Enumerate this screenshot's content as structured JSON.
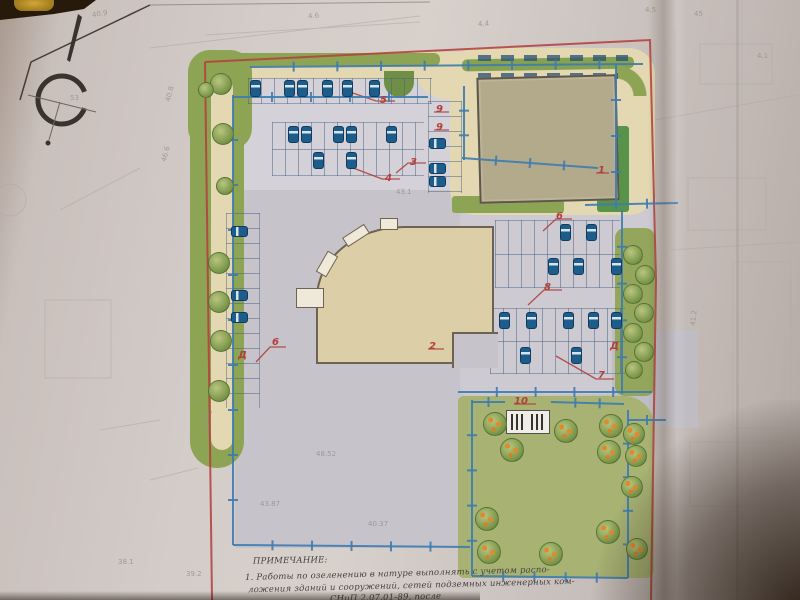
{
  "compass": {
    "north_letter": "С"
  },
  "callouts": [
    {
      "t": "5",
      "x": 380,
      "y": 95
    },
    {
      "t": "4",
      "x": 385,
      "y": 173
    },
    {
      "t": "3",
      "x": 410,
      "y": 157
    },
    {
      "t": "9",
      "x": 436,
      "y": 104
    },
    {
      "t": "9",
      "x": 436,
      "y": 122
    },
    {
      "t": "1",
      "x": 598,
      "y": 165
    },
    {
      "t": "2",
      "x": 429,
      "y": 341
    },
    {
      "t": "6",
      "x": 272,
      "y": 337
    },
    {
      "t": "Д",
      "x": 238,
      "y": 350
    },
    {
      "t": "6",
      "x": 556,
      "y": 211
    },
    {
      "t": "8",
      "x": 544,
      "y": 282
    },
    {
      "t": "Д",
      "x": 610,
      "y": 341
    },
    {
      "t": "7",
      "x": 598,
      "y": 370
    },
    {
      "t": "10",
      "x": 514,
      "y": 396
    }
  ],
  "survey_marks": [
    {
      "t": "40.9",
      "x": 92,
      "y": 10,
      "r": -8
    },
    {
      "t": "4.6",
      "x": 308,
      "y": 12,
      "r": -5
    },
    {
      "t": "4.4",
      "x": 478,
      "y": 20,
      "r": -4
    },
    {
      "t": "45",
      "x": 694,
      "y": 10,
      "r": 0
    },
    {
      "t": "4.1",
      "x": 757,
      "y": 52,
      "r": 0
    },
    {
      "t": "40.8",
      "x": 162,
      "y": 90,
      "r": -75
    },
    {
      "t": "46.6",
      "x": 158,
      "y": 150,
      "r": -75
    },
    {
      "t": "43.1",
      "x": 396,
      "y": 188,
      "r": 0
    },
    {
      "t": "48.52",
      "x": 316,
      "y": 450,
      "r": 0
    },
    {
      "t": "43.87",
      "x": 260,
      "y": 500,
      "r": 0
    },
    {
      "t": "41.62",
      "x": 198,
      "y": 416,
      "r": -80
    },
    {
      "t": "40.37",
      "x": 368,
      "y": 520,
      "r": 0
    },
    {
      "t": "41.2",
      "x": 686,
      "y": 314,
      "r": -85
    },
    {
      "t": "38.1",
      "x": 118,
      "y": 558,
      "r": 0
    },
    {
      "t": "39.2",
      "x": 186,
      "y": 570,
      "r": 0
    },
    {
      "t": "4.5",
      "x": 645,
      "y": 6,
      "r": 0
    },
    {
      "t": "53",
      "x": 70,
      "y": 94,
      "r": 0
    }
  ],
  "notes": {
    "lines": [
      {
        "t": "ПРИМЕЧАНИЕ:",
        "x": 253,
        "y": 556,
        "r": -1
      },
      {
        "t": "1. Работы по озеленению в натуре выполнять с учетом распо-",
        "x": 245,
        "y": 569,
        "r": -1.5
      },
      {
        "t": "ложения зданий и сооружений, сетей подземных инженерных ком-",
        "x": 248,
        "y": 581,
        "r": -1.5
      },
      {
        "t": "СНиП 2.07.01-89, после",
        "x": 330,
        "y": 593,
        "r": -1.5
      }
    ]
  },
  "plan": {
    "stalls": [
      {
        "x": 248,
        "y": 78,
        "w": 184,
        "h": 26,
        "o": "v",
        "mid": 0
      },
      {
        "x": 272,
        "y": 122,
        "w": 152,
        "h": 54,
        "o": "v",
        "mid": 1
      },
      {
        "x": 428,
        "y": 101,
        "w": 34,
        "h": 92,
        "o": "h",
        "mid": 0
      },
      {
        "x": 226,
        "y": 213,
        "w": 34,
        "h": 195,
        "o": "h",
        "mid": 0
      },
      {
        "x": 495,
        "y": 220,
        "w": 125,
        "h": 68,
        "o": "v",
        "mid": 1
      },
      {
        "x": 490,
        "y": 308,
        "w": 135,
        "h": 66,
        "o": "v",
        "mid": 1
      }
    ],
    "cars": [
      {
        "x": 250,
        "y": 80,
        "o": "v"
      },
      {
        "x": 284,
        "y": 80,
        "o": "v"
      },
      {
        "x": 297,
        "y": 80,
        "o": "v"
      },
      {
        "x": 322,
        "y": 80,
        "o": "v"
      },
      {
        "x": 342,
        "y": 80,
        "o": "v"
      },
      {
        "x": 369,
        "y": 80,
        "o": "v"
      },
      {
        "x": 288,
        "y": 126,
        "o": "v"
      },
      {
        "x": 301,
        "y": 126,
        "o": "v"
      },
      {
        "x": 333,
        "y": 126,
        "o": "v"
      },
      {
        "x": 346,
        "y": 126,
        "o": "v"
      },
      {
        "x": 386,
        "y": 126,
        "o": "v"
      },
      {
        "x": 313,
        "y": 152,
        "o": "v"
      },
      {
        "x": 346,
        "y": 152,
        "o": "v"
      },
      {
        "x": 429,
        "y": 138,
        "o": "h"
      },
      {
        "x": 429,
        "y": 163,
        "o": "h"
      },
      {
        "x": 429,
        "y": 176,
        "o": "h"
      },
      {
        "x": 231,
        "y": 226,
        "o": "h"
      },
      {
        "x": 231,
        "y": 290,
        "o": "h"
      },
      {
        "x": 231,
        "y": 312,
        "o": "h"
      },
      {
        "x": 560,
        "y": 224,
        "o": "v"
      },
      {
        "x": 586,
        "y": 224,
        "o": "v"
      },
      {
        "x": 548,
        "y": 258,
        "o": "v"
      },
      {
        "x": 573,
        "y": 258,
        "o": "v"
      },
      {
        "x": 611,
        "y": 258,
        "o": "v"
      },
      {
        "x": 499,
        "y": 312,
        "o": "v"
      },
      {
        "x": 526,
        "y": 312,
        "o": "v"
      },
      {
        "x": 563,
        "y": 312,
        "o": "v"
      },
      {
        "x": 588,
        "y": 312,
        "o": "v"
      },
      {
        "x": 611,
        "y": 312,
        "o": "v"
      },
      {
        "x": 520,
        "y": 347,
        "o": "v"
      },
      {
        "x": 571,
        "y": 347,
        "o": "v"
      }
    ],
    "trees": [
      {
        "x": 221,
        "y": 84,
        "r": 11,
        "f": 0
      },
      {
        "x": 223,
        "y": 134,
        "r": 11,
        "f": 0
      },
      {
        "x": 225,
        "y": 186,
        "r": 9,
        "f": 0
      },
      {
        "x": 219,
        "y": 263,
        "r": 11,
        "f": 0
      },
      {
        "x": 219,
        "y": 302,
        "r": 11,
        "f": 0
      },
      {
        "x": 221,
        "y": 341,
        "r": 11,
        "f": 0
      },
      {
        "x": 219,
        "y": 391,
        "r": 11,
        "f": 0
      },
      {
        "x": 206,
        "y": 90,
        "r": 8,
        "f": 0
      },
      {
        "x": 633,
        "y": 255,
        "r": 10,
        "f": 0
      },
      {
        "x": 645,
        "y": 275,
        "r": 10,
        "f": 0
      },
      {
        "x": 633,
        "y": 294,
        "r": 10,
        "f": 0
      },
      {
        "x": 644,
        "y": 313,
        "r": 10,
        "f": 0
      },
      {
        "x": 633,
        "y": 333,
        "r": 10,
        "f": 0
      },
      {
        "x": 644,
        "y": 352,
        "r": 10,
        "f": 0
      },
      {
        "x": 634,
        "y": 370,
        "r": 9,
        "f": 0
      },
      {
        "x": 495,
        "y": 424,
        "r": 12,
        "f": 1
      },
      {
        "x": 512,
        "y": 450,
        "r": 12,
        "f": 1
      },
      {
        "x": 566,
        "y": 431,
        "r": 12,
        "f": 1
      },
      {
        "x": 611,
        "y": 426,
        "r": 12,
        "f": 1
      },
      {
        "x": 609,
        "y": 452,
        "r": 12,
        "f": 1
      },
      {
        "x": 634,
        "y": 434,
        "r": 11,
        "f": 1
      },
      {
        "x": 636,
        "y": 456,
        "r": 11,
        "f": 1
      },
      {
        "x": 632,
        "y": 487,
        "r": 11,
        "f": 1
      },
      {
        "x": 487,
        "y": 519,
        "r": 12,
        "f": 1
      },
      {
        "x": 489,
        "y": 552,
        "r": 12,
        "f": 1
      },
      {
        "x": 551,
        "y": 554,
        "r": 12,
        "f": 1
      },
      {
        "x": 608,
        "y": 532,
        "r": 12,
        "f": 1
      },
      {
        "x": 637,
        "y": 549,
        "r": 11,
        "f": 1
      }
    ],
    "blue_lines": [
      [
        233,
        95,
        233,
        545,
        9
      ],
      [
        233,
        545,
        470,
        547,
        5
      ],
      [
        233,
        97,
        428,
        97,
        4
      ],
      [
        250,
        67,
        643,
        64,
        8
      ],
      [
        464,
        86,
        464,
        160,
        2
      ],
      [
        462,
        158,
        598,
        168,
        3
      ],
      [
        616,
        64,
        616,
        208,
        3
      ],
      [
        585,
        205,
        678,
        203,
        2
      ],
      [
        622,
        210,
        622,
        394,
        4
      ],
      [
        458,
        392,
        652,
        392,
        4
      ],
      [
        472,
        400,
        472,
        576,
        4
      ],
      [
        472,
        576,
        628,
        578,
        4
      ],
      [
        628,
        410,
        628,
        578,
        4
      ],
      [
        472,
        402,
        505,
        402,
        1
      ],
      [
        551,
        402,
        624,
        404,
        2
      ],
      [
        628,
        420,
        666,
        420,
        1
      ]
    ]
  },
  "colors": {
    "boundary_red": "#b5413d",
    "utility_blue": "#3e7cb0",
    "building_tan": "#dccea6",
    "building_khaki": "#b3a98b",
    "walkway_beige": "#e3d8b2",
    "greenery": "#8da454",
    "lawn": "#a7b273",
    "pavement_gray": "#c6c3cb",
    "paper": "#d4ccc8",
    "photo_background": "#241607",
    "car_blue": "#1d5d8c"
  }
}
